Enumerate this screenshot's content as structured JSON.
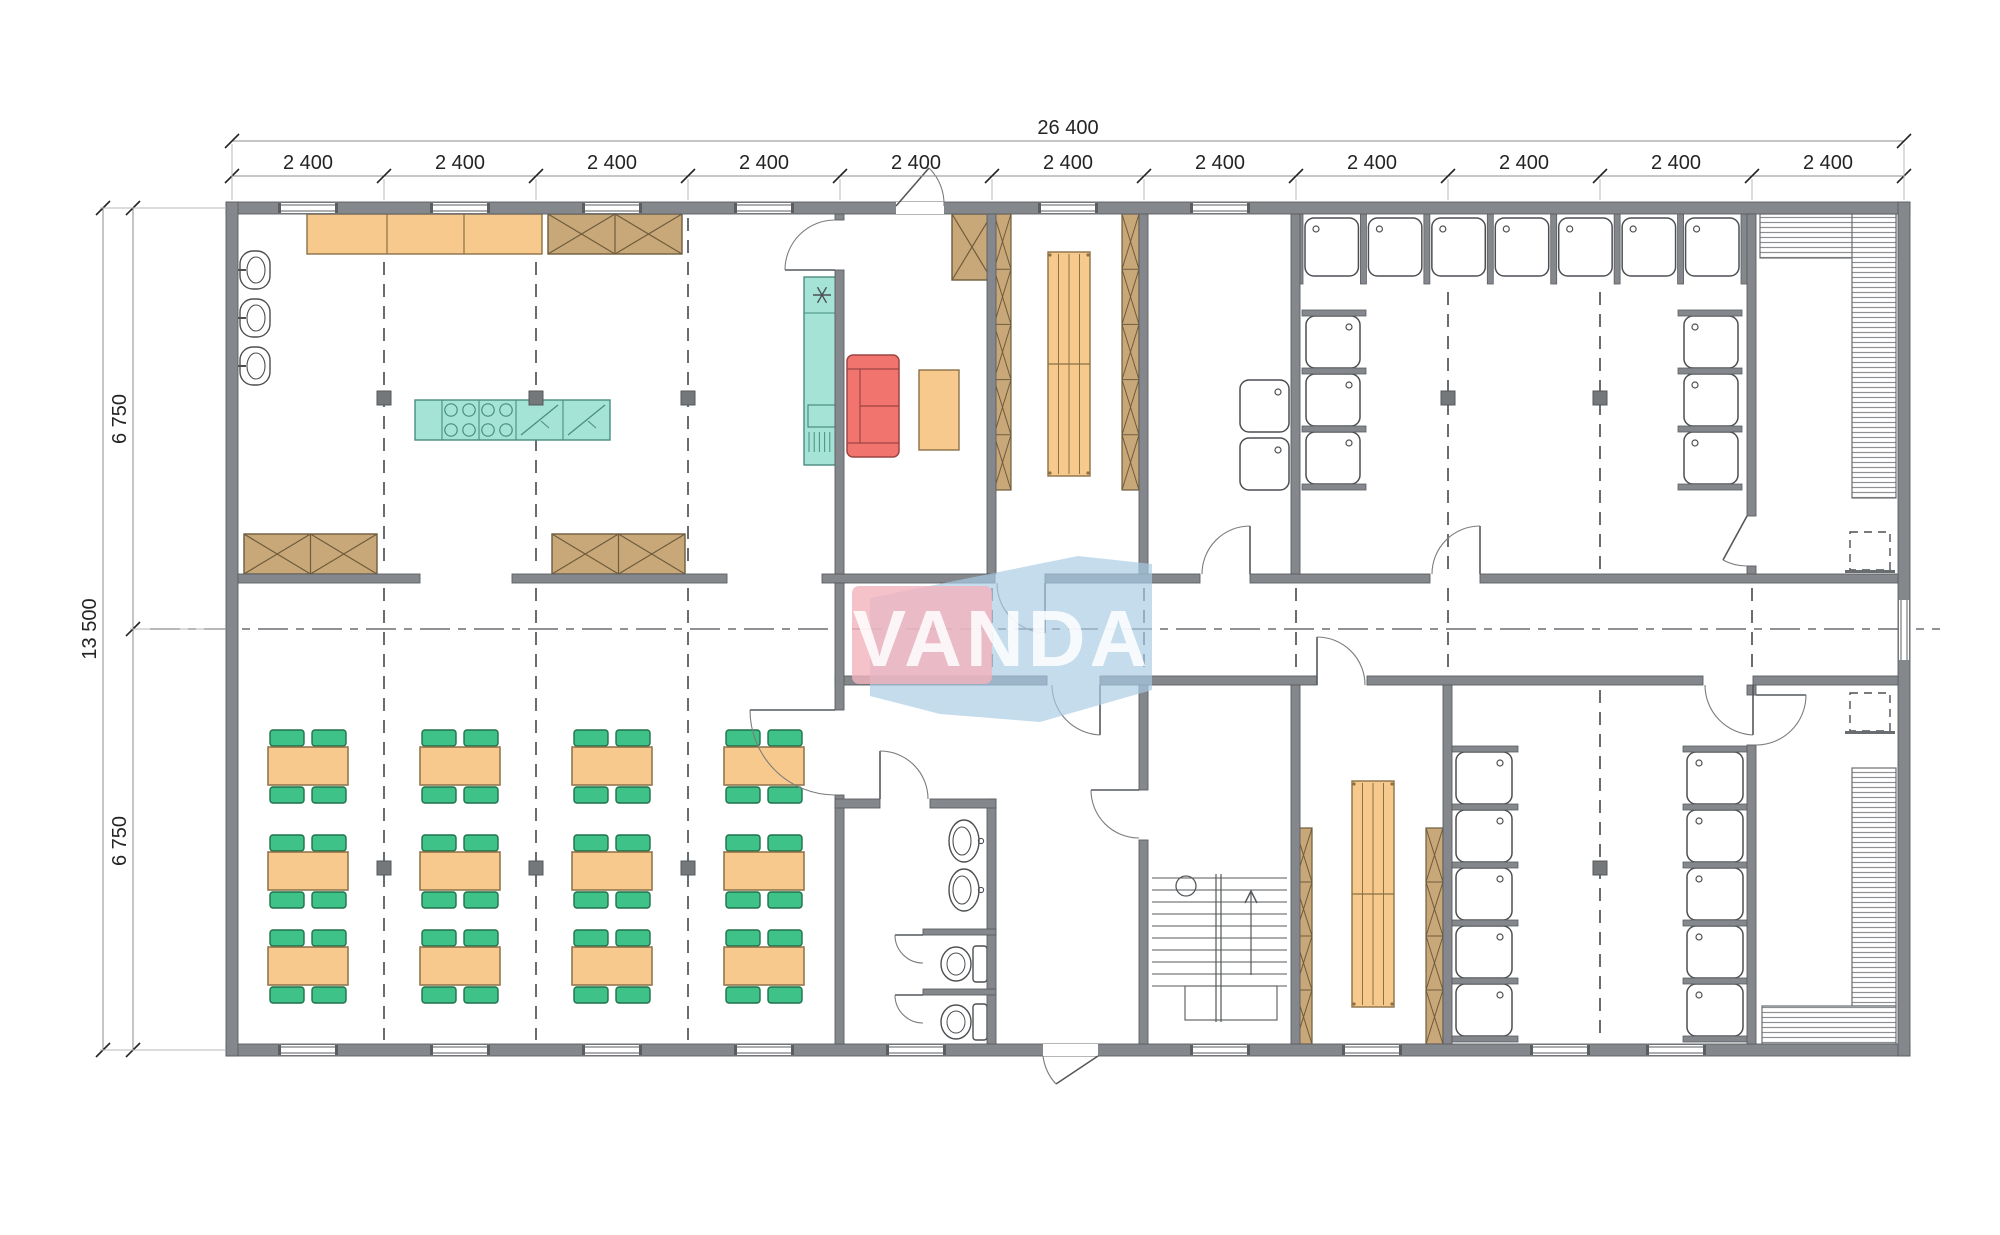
{
  "title": "Modular building floor plan",
  "watermark": {
    "text": "VANDA",
    "pink": "#f2b3bd",
    "blue": "#a9cbe4",
    "text_color": "rgba(255,255,255,0.85)"
  },
  "dimensions": {
    "overall_width": "26 400",
    "module": "2 400",
    "overall_height": "13 500",
    "half_height": "6 750",
    "modules": 11,
    "halves": 2
  },
  "palette": {
    "wall": "#84878b",
    "wall_edge": "#5b5e61",
    "orange": "#f8c98c",
    "orange_edge": "#8a7146",
    "tan": "#c8a878",
    "tan_edge": "#6e5c3d",
    "teal": "#a4e3d6",
    "teal_edge": "#4a8d81",
    "red": "#f1746f",
    "red_edge": "#9c4542",
    "green": "#3fc287",
    "green_edge": "#20714c",
    "line": "#4c4f52",
    "dim": "#242424",
    "dash": "#6a6d70",
    "hatch": "#8d9093",
    "white": "#ffffff"
  },
  "fixtures": {
    "dining_tables": {
      "rows": 3,
      "cols": 4,
      "chairs_each": 4
    },
    "kitchen_basins": 3,
    "shower_room_top": {
      "top": 7,
      "left": 3,
      "right": 3
    },
    "shower_room_bottom": {
      "left": 5,
      "right": 5
    },
    "wc": {
      "toilets": 2,
      "basins": 2
    },
    "laundry_trays": 2,
    "saunas": 2,
    "sauna_heaters": 2,
    "drying_benches": 2
  }
}
